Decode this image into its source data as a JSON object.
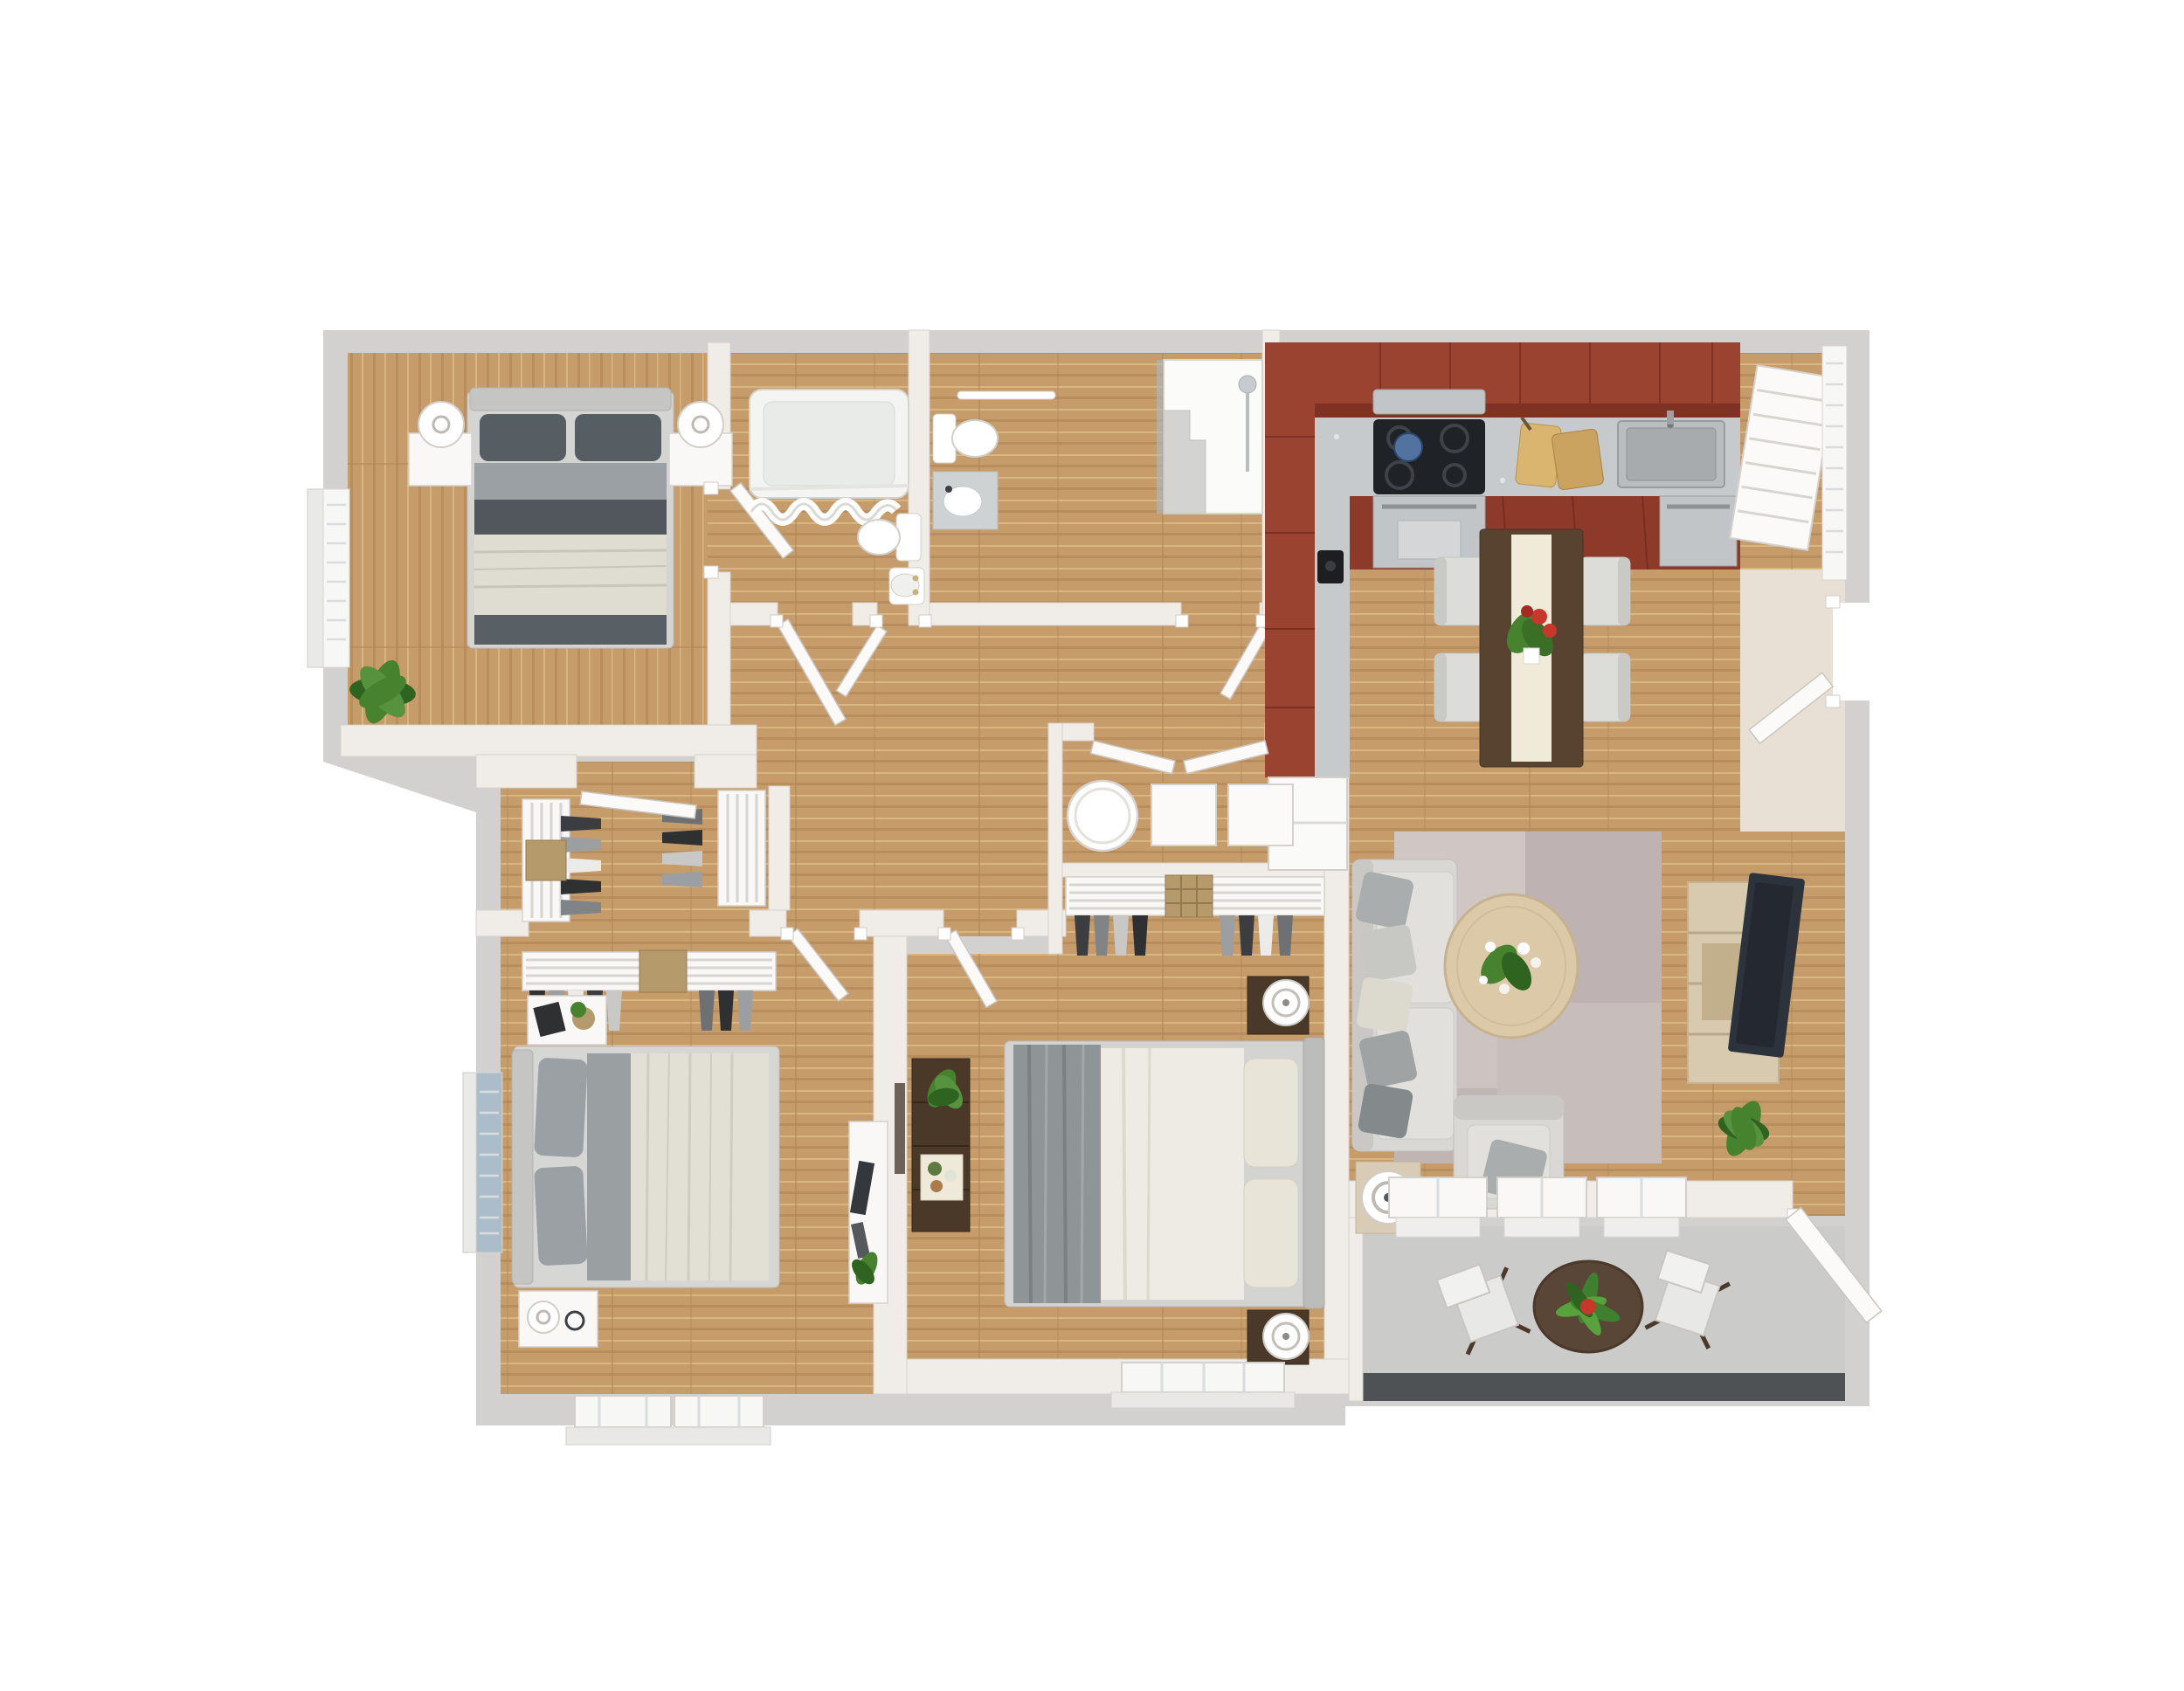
{
  "scene": {
    "kind": "3d-floor-plan-render",
    "view": "top-down dollhouse",
    "background": "#ffffff",
    "no_visible_text": true
  },
  "colors": {
    "bg": "#ffffff",
    "wall_outer": "#d3d1cf",
    "wall_inner": "#f0ede8",
    "wall_edge": "#d6d2cd",
    "wall_face_beige": "#e8e0d4",
    "white": "#f9f8f6",
    "floor_wood": "#c69c6a",
    "plank_dark": "#ad8352",
    "plank_light": "#d9b57f",
    "patio_floor": "#cbcbc9",
    "patio_edge": "#4e5254",
    "cabinet_red_top": "#9a4331",
    "cabinet_red_front": "#7f3224",
    "steel": "#c7cacc",
    "cooktop_black": "#1f2226",
    "kettle_blue": "#5272a0",
    "dining_table": "#57432f",
    "runner_cream": "#f0ead9",
    "chair_gray": "#dcddd9",
    "sofa_gray": "#d8d7d4",
    "cushion_light": "#e1e0dc",
    "pillow_dark": "#565d63",
    "pillow_gray": "#9aa0a4",
    "pillow_cream": "#e8e5d8",
    "rug_mauve": "#c7bdbb",
    "rug_light": "#d0c7c5",
    "rug_dark": "#beb3b2",
    "coffee_table_wood": "#dbc9a8",
    "console_wood": "#d7caae",
    "tv_dark": "#2d333d",
    "plant_green": "#47832f",
    "plant_dark_green": "#2f6420",
    "pot_terracotta": "#b4613e",
    "bed_blanket_cream": "#dfdcd1",
    "bed_sheet_white": "#edebe3",
    "bed_throw_gray": "#8f9496",
    "headboard_gray": "#c5c6c4",
    "nightstand_dark": "#4a3828",
    "glass_blue": "#aabdc9",
    "basket_tan": "#b59a6b",
    "flower_red": "#c8372b",
    "art_frame": "#6b6258"
  },
  "rooms": [
    {
      "id": "bedroom-1",
      "location": "top-left",
      "furniture": [
        "double-bed-dark-pillows",
        "nightstand-left",
        "nightstand-right",
        "lamp-left",
        "lamp-right",
        "potted-plant",
        "window-left-wall"
      ]
    },
    {
      "id": "bathroom-1",
      "location": "top-center-left",
      "furniture": [
        "bathtub-with-curtain",
        "toilet",
        "pedestal-sink"
      ]
    },
    {
      "id": "bathroom-2",
      "location": "top-center",
      "furniture": [
        "towel-bar",
        "toilet",
        "vanity-sink",
        "walk-in-shower-with-bench",
        "glass-panel"
      ]
    },
    {
      "id": "kitchen",
      "location": "top-right",
      "furniture": [
        "red-upper-cabinets-L",
        "stainless-counter",
        "cooktop",
        "kettle",
        "microwave",
        "cutting-boards",
        "double-sink",
        "oven",
        "dishwasher",
        "refrigerator",
        "coffee-maker",
        "pantry-shelves",
        "window-blinds"
      ]
    },
    {
      "id": "dining-area",
      "location": "right-center-top",
      "furniture": [
        "dark-wood-table",
        "table-runner",
        "red-flower-centerpiece",
        "chair-x4"
      ]
    },
    {
      "id": "living-room",
      "location": "right-center",
      "furniture": [
        "sofa-with-pillows",
        "area-rug-patchwork",
        "round-coffee-table-flowers",
        "side-table-lamp",
        "armchair-with-pillow",
        "tv-console",
        "wall-tv",
        "potted-plant"
      ]
    },
    {
      "id": "foyer-entry",
      "location": "right-edge",
      "furniture": [
        "entry-door-open"
      ]
    },
    {
      "id": "utility-closet",
      "location": "center",
      "furniture": [
        "water-heater",
        "washer",
        "dryer",
        "double-doors"
      ]
    },
    {
      "id": "walk-in-closet",
      "location": "center-left",
      "furniture": [
        "slatted-shelves-x2",
        "hanging-clothes",
        "baskets"
      ]
    },
    {
      "id": "bedroom-2",
      "location": "bottom-left",
      "furniture": [
        "double-bed-gray-pillows",
        "blue-window",
        "nightstand-top",
        "nightstand-bottom",
        "closet-with-clothes",
        "white-console",
        "bottom-windows-x2"
      ]
    },
    {
      "id": "bedroom-3",
      "location": "bottom-center",
      "furniture": [
        "double-bed-white-gray-throw",
        "dark-dresser-with-plant",
        "nightstand-x2-dark",
        "drum-lamps",
        "closet-with-clothes",
        "bottom-window",
        "wall-art"
      ]
    },
    {
      "id": "patio",
      "location": "bottom-right",
      "furniture": [
        "concrete-floor",
        "bistro-table-bromeliad",
        "folding-chair-x2",
        "window-wall",
        "patio-door-open",
        "edge-strip"
      ]
    }
  ]
}
